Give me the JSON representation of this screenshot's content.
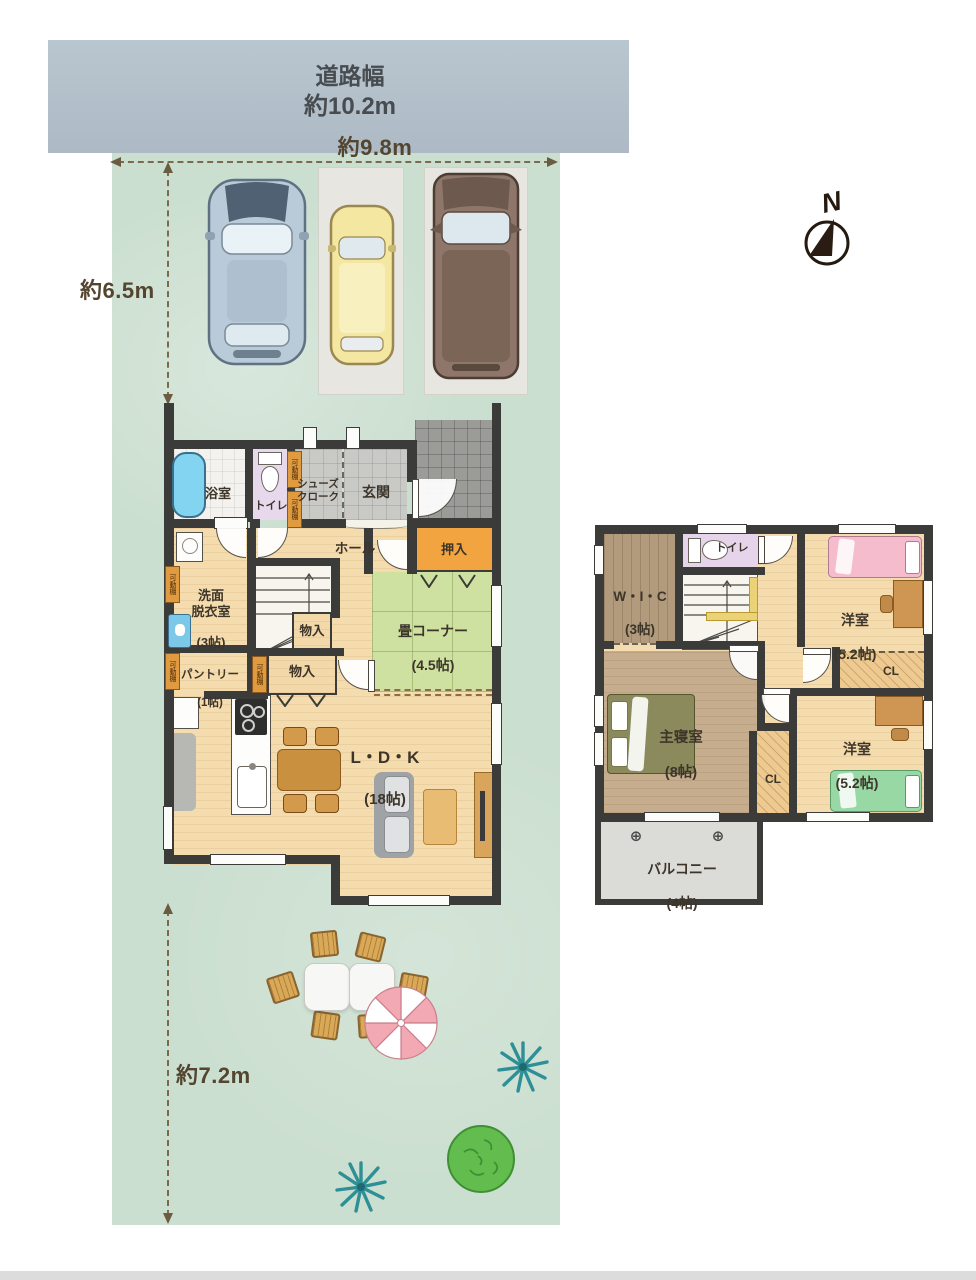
{
  "road": {
    "name": "道路幅",
    "width": "約10.2m"
  },
  "dims": {
    "front": "約9.8m",
    "upper": "約6.5m",
    "lower": "約7.2m"
  },
  "compass": {
    "north": "N"
  },
  "f1": {
    "bath": {
      "name": "浴室"
    },
    "toilet": {
      "name": "トイレ"
    },
    "shoes": {
      "name": "シューズ\nクローク"
    },
    "entrance": {
      "name": "玄関"
    },
    "hall": {
      "name": "ホール"
    },
    "oshiire": {
      "name": "押入"
    },
    "wash": {
      "name": "洗面\n脱衣室",
      "size": "(3帖)"
    },
    "tatami": {
      "name": "畳コーナー",
      "size": "(4.5帖)"
    },
    "storage1": {
      "name": "物入"
    },
    "storage2": {
      "name": "物入"
    },
    "pantry": {
      "name": "パントリー",
      "size": "(1帖)"
    },
    "ldk": {
      "name": "L・D・K",
      "size": "(18帖)"
    },
    "shelf_tag": "可動棚"
  },
  "f2": {
    "wic": {
      "name": "W・I・C",
      "size": "(3帖)"
    },
    "toilet": {
      "name": "トイレ"
    },
    "bedroom1": {
      "name": "洋室",
      "size": "(5.2帖)"
    },
    "bedroom2": {
      "name": "洋室",
      "size": "(5.2帖)"
    },
    "master": {
      "name": "主寝室",
      "size": "(8帖)"
    },
    "cl1": {
      "name": "CL"
    },
    "cl2": {
      "name": "CL"
    },
    "balcony": {
      "name": "バルコニー",
      "size": "(4帖)",
      "marker": "⊕"
    }
  }
}
